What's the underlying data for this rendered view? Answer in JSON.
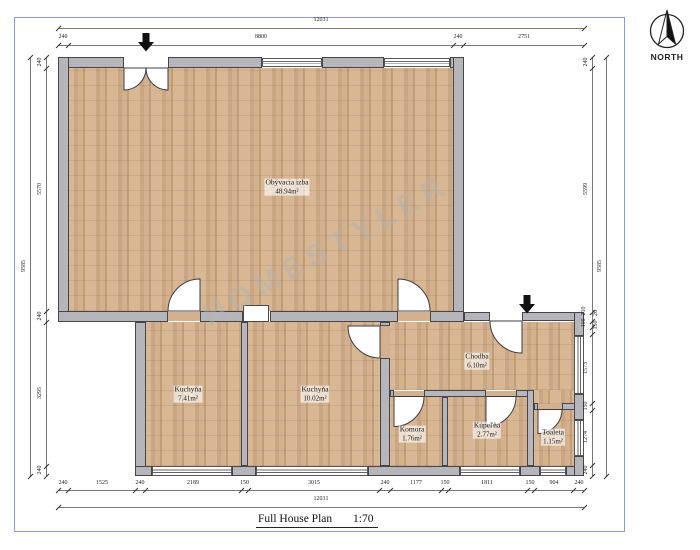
{
  "page": {
    "watermark": "HOMESTYLER"
  },
  "north_indicator": {
    "label": "NORTH"
  },
  "title_block": {
    "name": "Full House Plan",
    "scale": "1:70"
  },
  "rooms": [
    {
      "name": "Obývacia izba",
      "area": "48.94m²"
    },
    {
      "name": "Kuchyňa",
      "area": "7.41m²"
    },
    {
      "name": "Kuchyňa",
      "area": "10.02m²"
    },
    {
      "name": "Chodba",
      "area": "6.10m²"
    },
    {
      "name": "Komora",
      "area": "1.76m²"
    },
    {
      "name": "Kúpeľňa",
      "area": "2.77m²"
    },
    {
      "name": "Toaleta",
      "area": "1.15m²"
    }
  ],
  "dimensions": {
    "top": {
      "overall": "12031",
      "segments": [
        "240",
        "8800",
        "240",
        "2751"
      ]
    },
    "bottom": {
      "overall": "12031",
      "segments": [
        "240",
        "1525",
        "240",
        "2189",
        "150",
        "3015",
        "240",
        "1177",
        "150",
        "1811",
        "150",
        "904",
        "240"
      ]
    },
    "left": {
      "overall": "9585",
      "segments": [
        "240",
        "5570",
        "240",
        "3295",
        "240"
      ]
    },
    "right": {
      "overall": "9585",
      "segments": [
        "240",
        "5599",
        "210",
        "116",
        "26",
        "150",
        "1573",
        "150",
        "1274",
        "240"
      ]
    }
  },
  "colors": {
    "wall_fill": "#b6b6ba",
    "wall_line": "#45454b",
    "floor": "#cfae8c",
    "page_border": "#8b9ad6",
    "dimension_line": "#777777",
    "watermark": "#b2b2b2"
  }
}
